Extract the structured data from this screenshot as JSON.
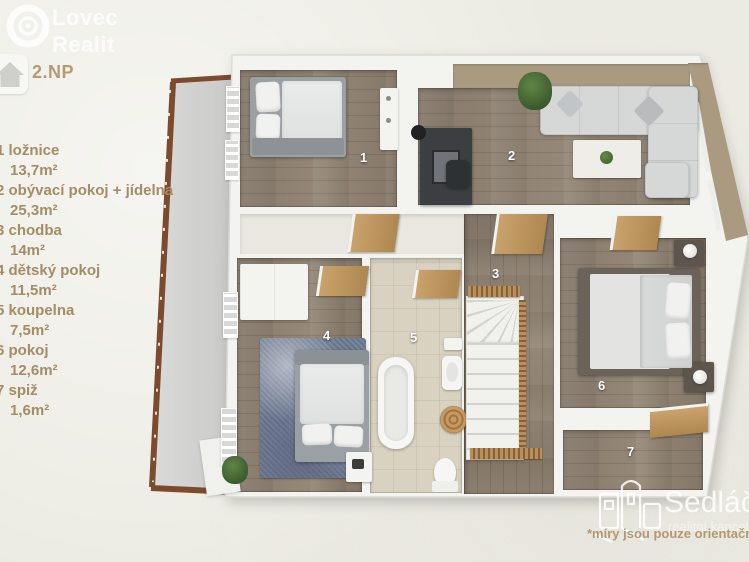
{
  "brand": {
    "logo_line1": "Lovec",
    "logo_line2": "Realit"
  },
  "floor": {
    "label": "2.NP"
  },
  "legend": [
    {
      "label": "1 ložnice",
      "area": "13,7m²"
    },
    {
      "label": "2 obývací pokoj + jídelna",
      "area": "25,3m²"
    },
    {
      "label": "3 chodba",
      "area": "14m²"
    },
    {
      "label": "4 dětský pokoj",
      "area": "11,5m²"
    },
    {
      "label": "5 koupelna",
      "area": "7,5m²"
    },
    {
      "label": "6 pokoj",
      "area": "12,6m²"
    },
    {
      "label": "7 spiž",
      "area": "1,6m²"
    }
  ],
  "rooms": [
    {
      "number": "1"
    },
    {
      "number": "2"
    },
    {
      "number": "3"
    },
    {
      "number": "4"
    },
    {
      "number": "5"
    },
    {
      "number": "6"
    },
    {
      "number": "7"
    }
  ],
  "watermark": {
    "brand": "Sedláček",
    "tagline": "realitní kancelář",
    "disclaimer": "*míry jsou pouze orientační"
  },
  "colors": {
    "background": "#ecebe3",
    "accent_text": "#a48c66",
    "floor_label": "#b59b74",
    "wood_floor": "#8e8174",
    "tile_floor": "#d9d2c1",
    "accent_wall": "#a99a80",
    "railing": "#7c4a2c",
    "walls": "#f3f3f0"
  }
}
